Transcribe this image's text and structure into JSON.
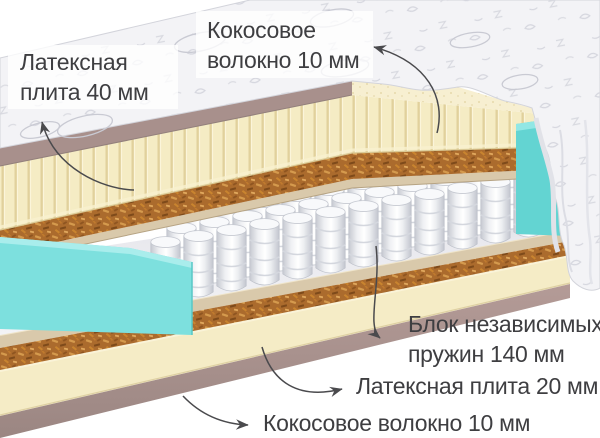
{
  "labels": {
    "latex_top": {
      "line1": "Латексная",
      "line2": "плита 40 мм"
    },
    "coir_top": {
      "line1": "Кокосовое",
      "line2": "волокно 10 мм"
    },
    "springs": {
      "line1": "Блок независимых",
      "line2": "пружин 140 мм"
    },
    "latex_bottom": {
      "text": "Латексная плита 20 мм"
    },
    "coir_bottom": {
      "text": "Кокосовое волокно 10 мм"
    }
  },
  "layers_top_to_bottom": [
    "Кокосовое волокно 10 мм",
    "Латексная плита 40 мм",
    "Блок независимых пружин 140 мм",
    "Латексная плита 20 мм",
    "Кокосовое волокно 10 мм"
  ],
  "colors": {
    "cover_white": "#f3f3f6",
    "border_mauve": "#a8908c",
    "latex_cream": "#f5ecc4",
    "coir_brown": "#ab6b2d",
    "board_tan": "#d9c9ab",
    "spring_white": "#ffffff",
    "foam_teal": "#6fd8d6",
    "text": "#3e3e41",
    "arrow": "#4a4a4d"
  }
}
